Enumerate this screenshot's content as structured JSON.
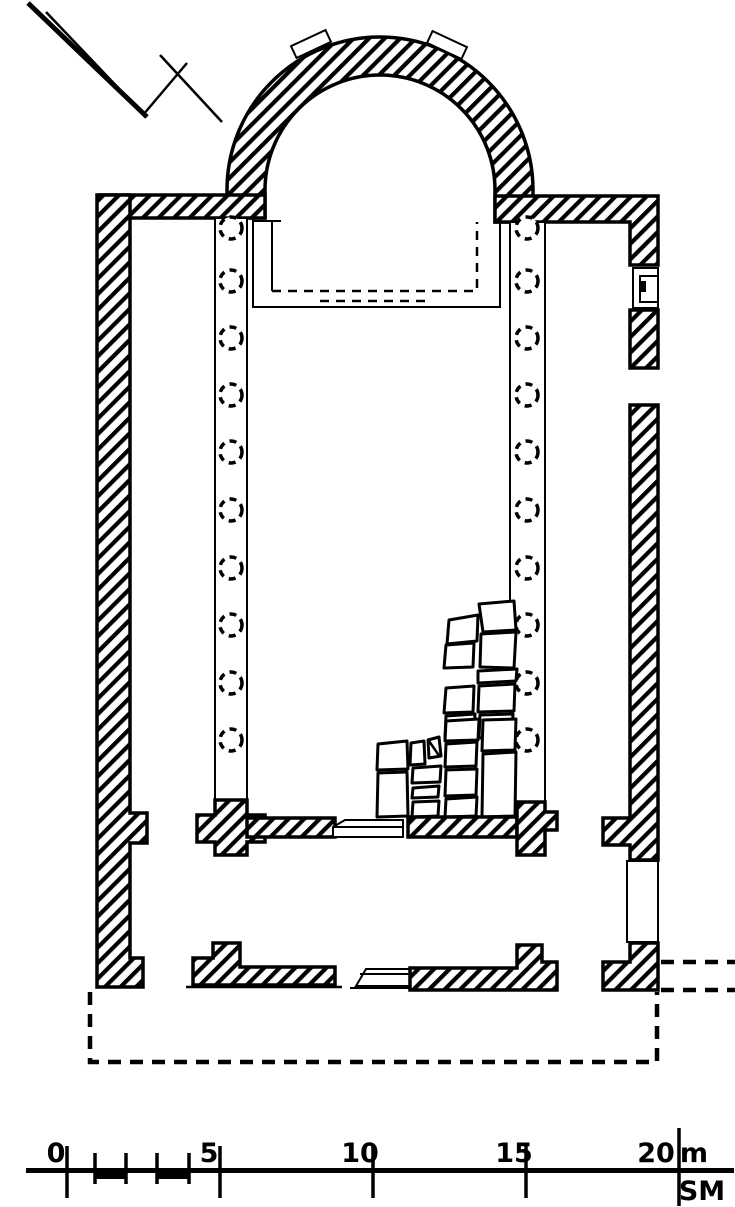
{
  "colors": {
    "ink": "#000000",
    "paper": "#ffffff"
  },
  "scale_bar": {
    "tick_labels": [
      "0",
      "5",
      "10",
      "15",
      "20"
    ],
    "unit": "m",
    "initials": "SM"
  },
  "plan": {
    "column_bases_left_count": 10,
    "column_bases_right_count": 10
  }
}
